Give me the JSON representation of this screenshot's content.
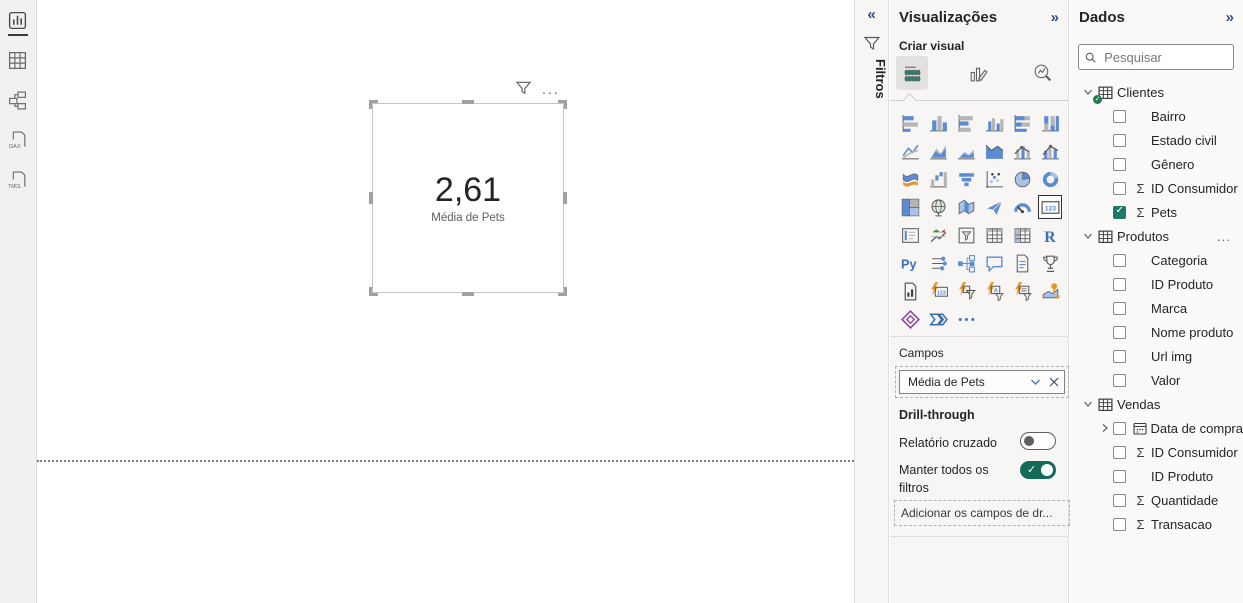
{
  "colors": {
    "accent_teal": "#1e7a66",
    "toggle_on": "#136a58",
    "icon_blue": "#5b8bd3",
    "pane_bg": "#f7f6f5"
  },
  "left_nav": {
    "items": [
      {
        "name": "report-view",
        "active": true
      },
      {
        "name": "table-view",
        "active": false
      },
      {
        "name": "model-view",
        "active": false
      },
      {
        "name": "dax-query-view",
        "active": false,
        "label": "DAX"
      },
      {
        "name": "tmdl-view",
        "active": false,
        "label": "TMDL"
      }
    ]
  },
  "canvas": {
    "visual": {
      "type": "card",
      "value": "2,61",
      "label": "Média de Pets"
    },
    "toolbar": {
      "more_label": "..."
    }
  },
  "filters_rail": {
    "title": "Filtros",
    "collapse_icon": "«"
  },
  "viz_pane": {
    "title": "Visualizações",
    "collapse_icon": "»",
    "create_visual_label": "Criar visual",
    "tabs": [
      {
        "name": "build-visual",
        "kind": "tabBuild",
        "selected": true
      },
      {
        "name": "format-visual",
        "kind": "tabFormat",
        "selected": false
      },
      {
        "name": "analytics",
        "kind": "tabAnalytics",
        "selected": false
      }
    ],
    "gallery": [
      {
        "name": "stacked-bar-chart",
        "kind": "barsH1"
      },
      {
        "name": "stacked-column-chart",
        "kind": "barsV1"
      },
      {
        "name": "clustered-bar-chart",
        "kind": "barsH2"
      },
      {
        "name": "clustered-column-chart",
        "kind": "barsV2"
      },
      {
        "name": "100-stacked-bar-chart",
        "kind": "barsH3"
      },
      {
        "name": "100-stacked-column-chart",
        "kind": "barsV3"
      },
      {
        "name": "line-chart",
        "kind": "line"
      },
      {
        "name": "area-chart",
        "kind": "area"
      },
      {
        "name": "stacked-area-chart",
        "kind": "areas"
      },
      {
        "name": "100-stacked-area-chart",
        "kind": "areaf"
      },
      {
        "name": "line-and-stacked-column-chart",
        "kind": "comboS"
      },
      {
        "name": "line-and-clustered-column-chart",
        "kind": "comboC"
      },
      {
        "name": "ribbon-chart",
        "kind": "ribbon"
      },
      {
        "name": "waterfall-chart",
        "kind": "waterfall"
      },
      {
        "name": "funnel-chart",
        "kind": "funnel"
      },
      {
        "name": "scatter-chart",
        "kind": "scatter"
      },
      {
        "name": "pie-chart",
        "kind": "pie"
      },
      {
        "name": "donut-chart",
        "kind": "donut"
      },
      {
        "name": "treemap",
        "kind": "treemap"
      },
      {
        "name": "map",
        "kind": "globe"
      },
      {
        "name": "filled-map",
        "kind": "fmap"
      },
      {
        "name": "azure-map",
        "kind": "azmap"
      },
      {
        "name": "gauge",
        "kind": "gauge"
      },
      {
        "name": "card",
        "kind": "card123",
        "selected": true
      },
      {
        "name": "multi-row-card",
        "kind": "mcard"
      },
      {
        "name": "kpi",
        "kind": "kpi"
      },
      {
        "name": "slicer",
        "kind": "slicer"
      },
      {
        "name": "table",
        "kind": "table"
      },
      {
        "name": "matrix",
        "kind": "matrix"
      },
      {
        "name": "r-script-visual",
        "kind": "Rtxt"
      },
      {
        "name": "python-visual",
        "kind": "Pytxt"
      },
      {
        "name": "key-influencers",
        "kind": "keyinf"
      },
      {
        "name": "decomposition-tree",
        "kind": "dtree"
      },
      {
        "name": "qa-visual",
        "kind": "qa"
      },
      {
        "name": "smart-narrative",
        "kind": "doc"
      },
      {
        "name": "metrics",
        "kind": "trophy"
      },
      {
        "name": "paginated-report",
        "kind": "pagrep"
      },
      {
        "name": "new-card",
        "kind": "b123"
      },
      {
        "name": "new-slicer",
        "kind": "bslicer"
      },
      {
        "name": "text-slicer",
        "kind": "bA"
      },
      {
        "name": "button-slicer",
        "kind": "blist"
      },
      {
        "name": "arcgis-map",
        "kind": "arcgis"
      },
      {
        "name": "power-apps",
        "kind": "papps"
      },
      {
        "name": "power-automate",
        "kind": "pauto"
      },
      {
        "name": "more-visuals",
        "kind": "dots"
      }
    ],
    "fields_label": "Campos",
    "field_well": {
      "value": "Média de Pets"
    },
    "drillthrough": {
      "label": "Drill-through",
      "cross_report_label": "Relatório cruzado",
      "cross_report_on": false,
      "keep_all_filters_label": "Manter todos os filtros",
      "keep_all_filters_on": true,
      "add_fields_placeholder": "Adicionar os campos de dr..."
    }
  },
  "data_pane": {
    "title": "Dados",
    "collapse_icon": "»",
    "search_placeholder": "Pesquisar",
    "tables": [
      {
        "name": "Clientes",
        "badge": true,
        "more": "",
        "fields": [
          {
            "label": "Bairro",
            "sigma": false,
            "checked": false
          },
          {
            "label": "Estado civil",
            "sigma": false,
            "checked": false
          },
          {
            "label": "Gênero",
            "sigma": false,
            "checked": false
          },
          {
            "label": "ID Consumidor",
            "sigma": true,
            "checked": false
          },
          {
            "label": "Pets",
            "sigma": true,
            "checked": true
          }
        ]
      },
      {
        "name": "Produtos",
        "badge": false,
        "more": "...",
        "fields": [
          {
            "label": "Categoria",
            "sigma": false,
            "checked": false
          },
          {
            "label": "ID Produto",
            "sigma": false,
            "checked": false
          },
          {
            "label": "Marca",
            "sigma": false,
            "checked": false
          },
          {
            "label": "Nome produto",
            "sigma": false,
            "checked": false
          },
          {
            "label": "Url img",
            "sigma": false,
            "checked": false
          },
          {
            "label": "Valor",
            "sigma": false,
            "checked": false
          }
        ]
      },
      {
        "name": "Vendas",
        "badge": false,
        "more": "",
        "fields": [
          {
            "label": "Data de compra",
            "sigma": false,
            "checked": false,
            "calendar": true,
            "expandable": true
          },
          {
            "label": "ID Consumidor",
            "sigma": true,
            "checked": false
          },
          {
            "label": "ID Produto",
            "sigma": false,
            "checked": false
          },
          {
            "label": "Quantidade",
            "sigma": true,
            "checked": false
          },
          {
            "label": "Transacao",
            "sigma": true,
            "checked": false
          }
        ]
      }
    ]
  }
}
